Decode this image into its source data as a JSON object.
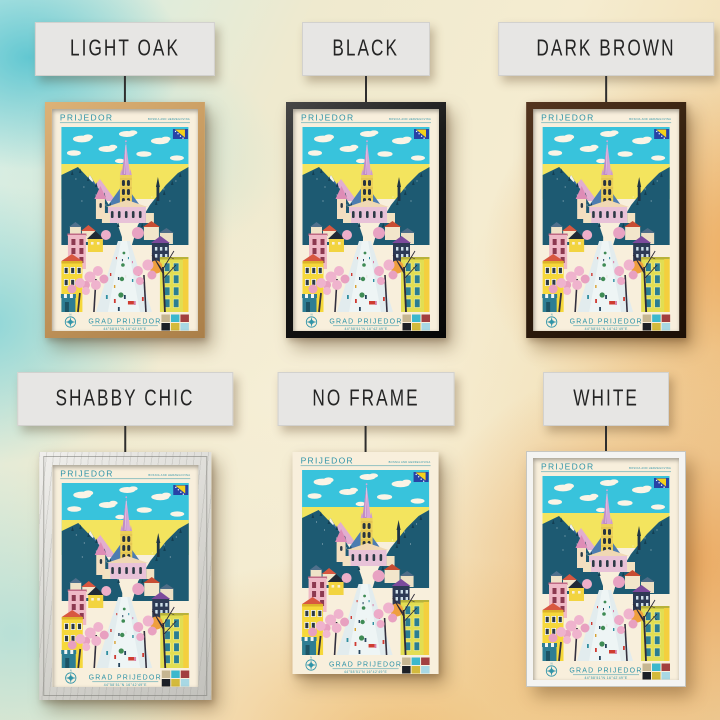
{
  "variants": [
    {
      "id": "light-oak",
      "label": "LIGHT OAK"
    },
    {
      "id": "black",
      "label": "BLACK"
    },
    {
      "id": "dark-brown",
      "label": "DARK BROWN"
    },
    {
      "id": "shabby-chic",
      "label": "SHABBY CHIC"
    },
    {
      "id": "no-frame",
      "label": "NO FRAME"
    },
    {
      "id": "white",
      "label": "WHITE"
    }
  ],
  "poster": {
    "title": "PRIJEDOR",
    "country": "BOSNIA AND HERZEGOVINA",
    "city_label": "GRAD PRIJEDOR",
    "coordinates": "44°58'51\"N 16°42'49\"E",
    "compass_n": "N",
    "palette": [
      "#c6b691",
      "#3cb8cd",
      "#a23f3f",
      "#1c2026",
      "#d3ba3c",
      "#a8d8e4"
    ],
    "flag": {
      "field": "#2743a6",
      "triangle": "#f5d21c",
      "stars": "#ffffff"
    },
    "text_color": "#2e93a8"
  }
}
